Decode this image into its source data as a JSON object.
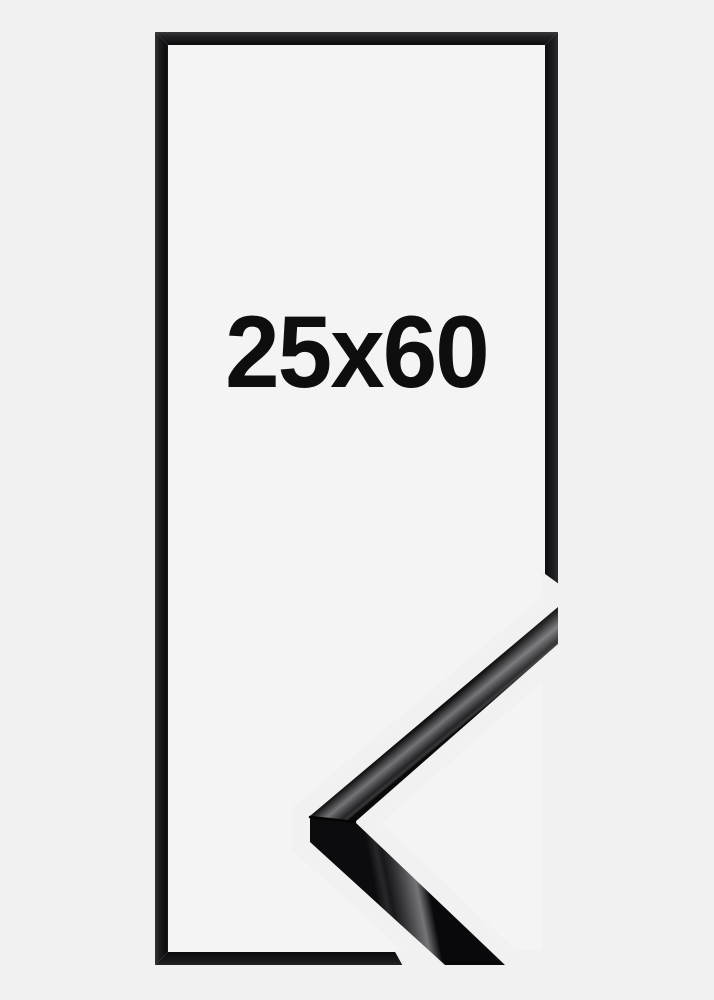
{
  "product_photo": {
    "size_label": "25x60",
    "frame_color_name": "black",
    "colors": {
      "background": "#f1f1f2",
      "frame_interior": "#f4f4f5",
      "frame_black": "#141416",
      "moulding_highlight": "#737375",
      "label_text": "#0e0e0e"
    }
  }
}
